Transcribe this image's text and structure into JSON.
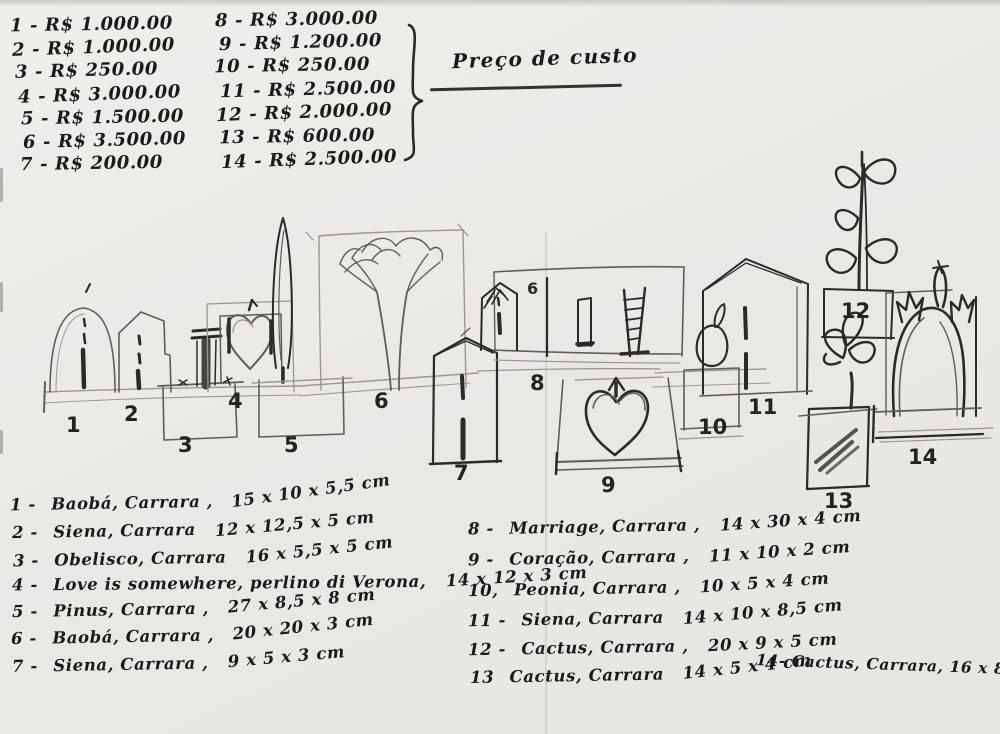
{
  "paper": {
    "bg": "#eae9e6",
    "ink": "#1b1a18",
    "pencil": "#9b9891"
  },
  "price_list": {
    "heading": "Preço de custo",
    "column1": [
      "1 - R$ 1.000.00",
      "2 - R$ 1.000.00",
      "3 - R$ 250.00",
      "4 - R$ 3.000.00",
      "5 - R$ 1.500.00",
      "6 - R$ 3.500.00",
      "7 - R$ 200.00"
    ],
    "column2": [
      "8 - R$ 3.000.00",
      "9 - R$ 1.200.00",
      "10 - R$ 250.00",
      "11 - R$ 2.500.00",
      "12 - R$ 2.000.00",
      "13 - R$ 600.00",
      "14 - R$ 2.500.00"
    ]
  },
  "catalog": {
    "left": [
      {
        "num": "1 -",
        "name": "Baobá, Carrara ,",
        "dims": "15 x 10 x 5,5 cm"
      },
      {
        "num": "2 -",
        "name": "Siena, Carrara",
        "dims": "12 x 12,5 x 5 cm"
      },
      {
        "num": "3 -",
        "name": "Obelisco, Carrara",
        "dims": "16 x 5,5 x 5 cm"
      },
      {
        "num": "4 -",
        "name": "Love is somewhere, perlino di Verona,",
        "dims": "14 x 12 x 3 cm"
      },
      {
        "num": "5 -",
        "name": "Pinus, Carrara ,",
        "dims": "27 x 8,5 x 8 cm"
      },
      {
        "num": "6 -",
        "name": "Baobá, Carrara ,",
        "dims": "20 x 20 x 3 cm"
      },
      {
        "num": "7 -",
        "name": "Siena, Carrara ,",
        "dims": "9 x 5 x 3 cm"
      }
    ],
    "right": [
      {
        "num": "8 -",
        "name": "Marriage, Carrara ,",
        "dims": "14 x 30 x 4 cm"
      },
      {
        "num": "9 -",
        "name": "Coração, Carrara ,",
        "dims": "11 x 10 x 2 cm"
      },
      {
        "num": "10,",
        "name": "Peonia, Carrara ,",
        "dims": "10 x 5 x 4 cm"
      },
      {
        "num": "11 -",
        "name": "Siena, Carrara",
        "dims": "14 x 10 x 8,5 cm"
      },
      {
        "num": "12 -",
        "name": "Cactus, Carrara ,",
        "dims": "20 x 9 x 5 cm"
      },
      {
        "num": "13",
        "name": "Cactus, Carrara",
        "dims": "14 x 5 x 4 cm"
      }
    ],
    "item14_inline": "14- Cactus, Carrara, 16 x 8 x 4,5 cm"
  },
  "sketch": {
    "labels": [
      "1",
      "2",
      "3",
      "4",
      "5",
      "6",
      "7",
      "8",
      "9",
      "10",
      "11",
      "12",
      "13",
      "14"
    ],
    "slab_mark": "6"
  }
}
